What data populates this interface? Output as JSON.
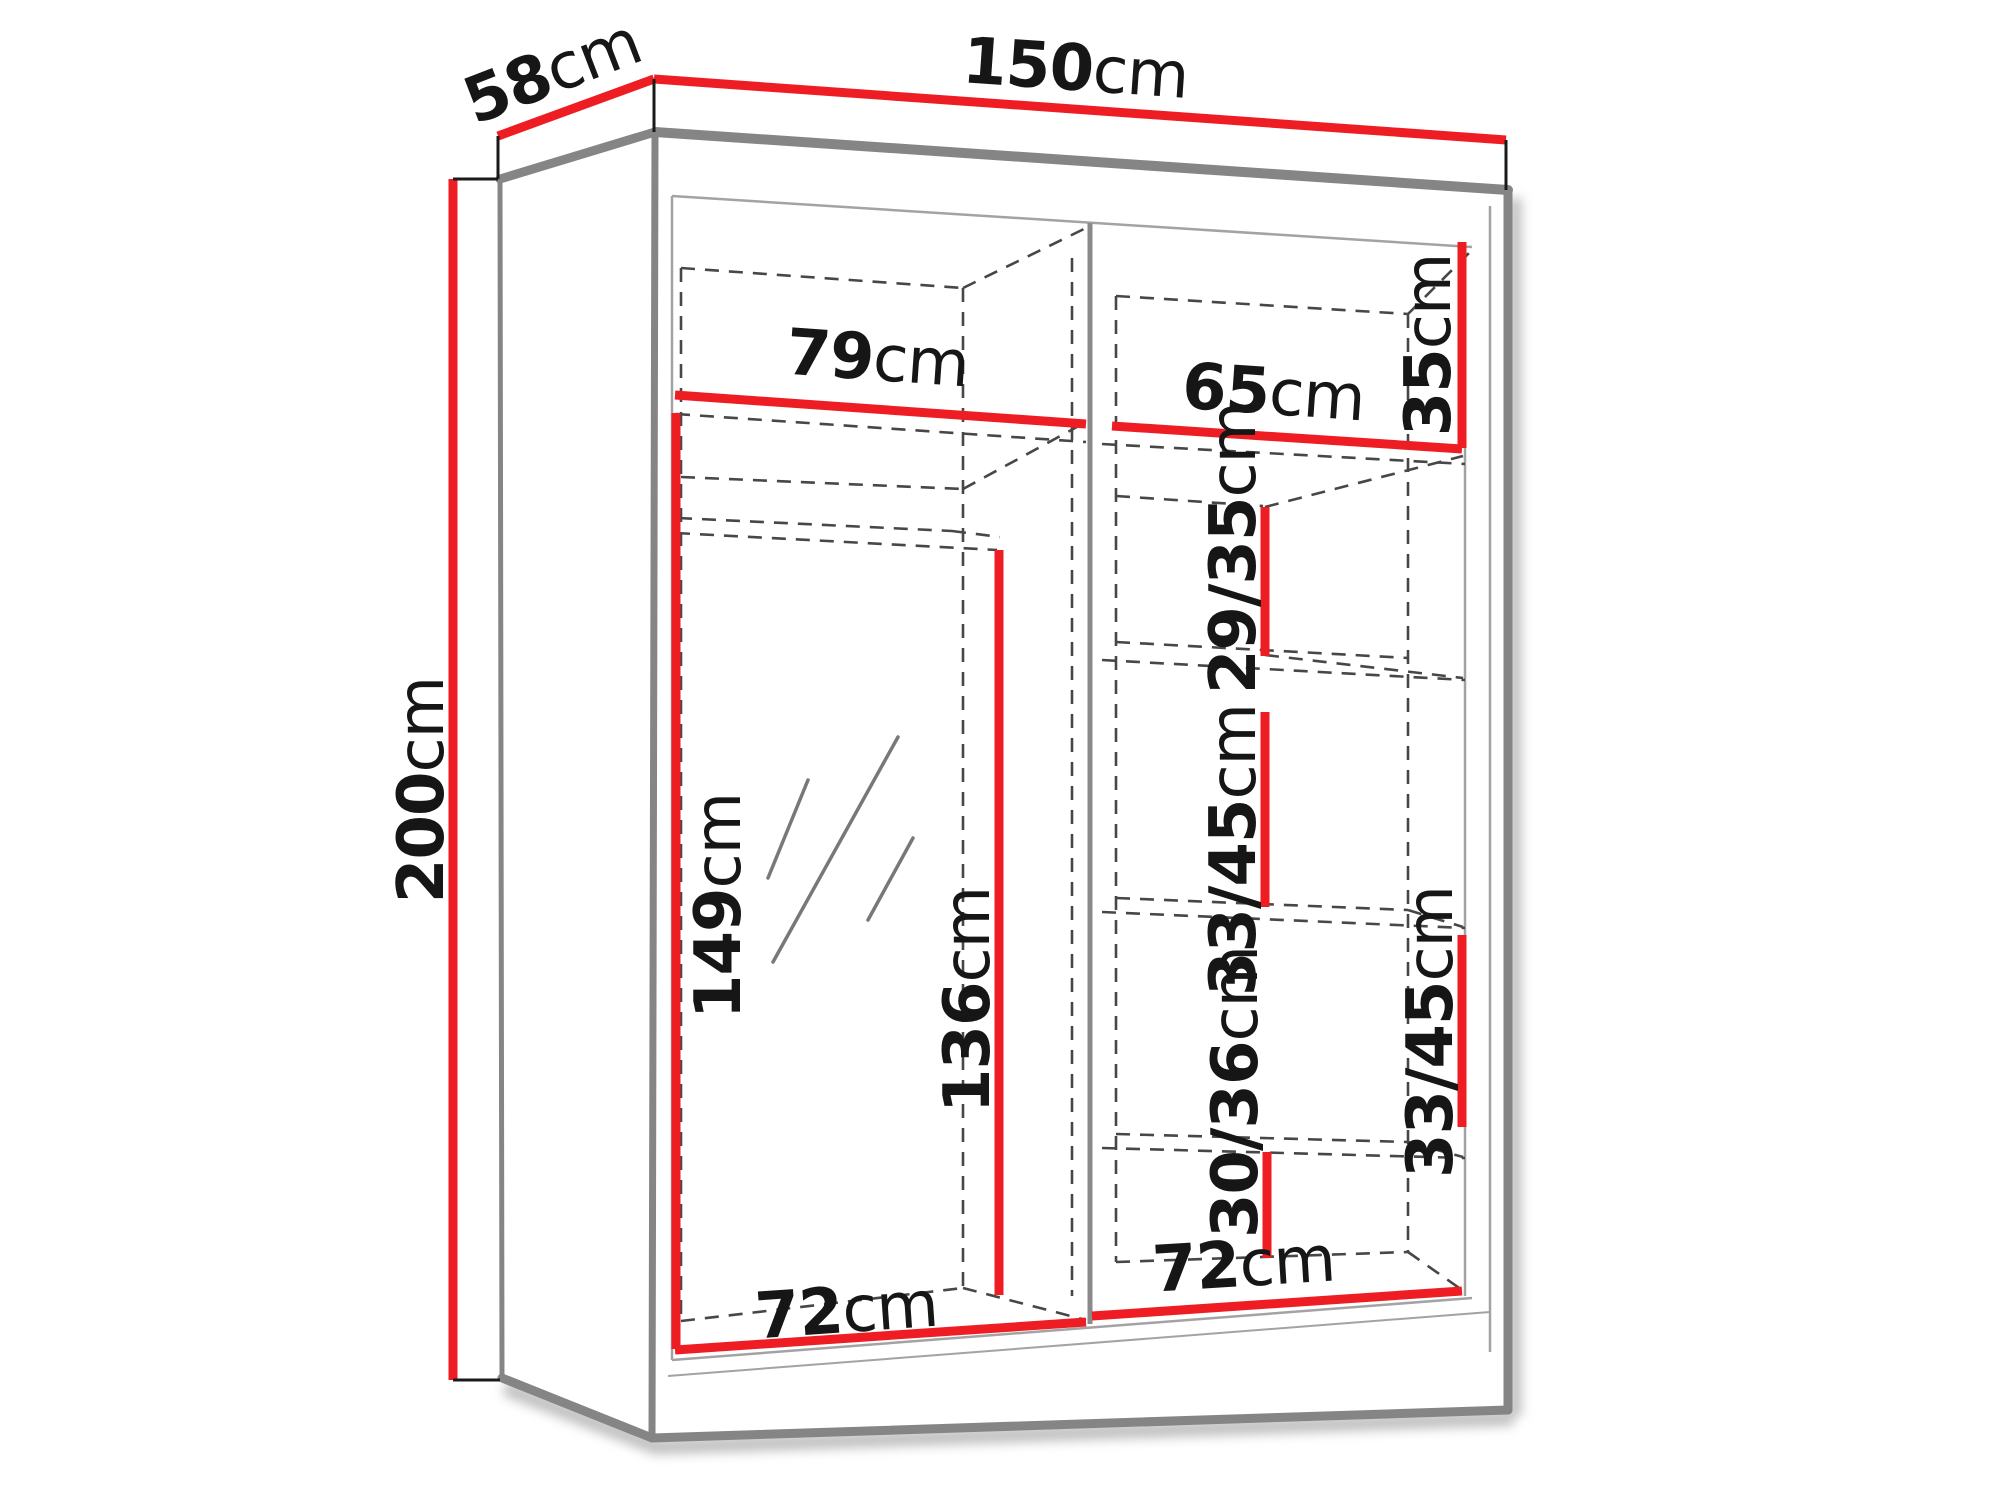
{
  "diagram": {
    "type": "furniture-dimension-diagram",
    "subject": "two-door sliding wardrobe with mirror, exterior and interior dimensions",
    "unit": "cm",
    "colors": {
      "dimension_line_red": "#ee1d23",
      "edge_gray": "#878787",
      "dashed_gray": "#474747",
      "text_black": "#161616",
      "background": "#ffffff"
    },
    "dimensions": {
      "overall": {
        "width": {
          "value": "150",
          "unit": "cm"
        },
        "depth": {
          "value": "58",
          "unit": "cm"
        },
        "height": {
          "value": "200",
          "unit": "cm"
        }
      },
      "top_shelf": {
        "left_width": {
          "value": "79",
          "unit": "cm"
        },
        "right_width": {
          "value": "65",
          "unit": "cm"
        },
        "height": {
          "value": "35",
          "unit": "cm"
        }
      },
      "left_compartment": {
        "front_height": {
          "value": "149",
          "unit": "cm"
        },
        "back_height": {
          "value": "136",
          "unit": "cm"
        },
        "bottom_width": {
          "value": "72",
          "unit": "cm"
        }
      },
      "right_compartment": {
        "upper_gap": {
          "value": "29/35",
          "unit": "cm"
        },
        "middle_gap": {
          "value": "33/45",
          "unit": "cm"
        },
        "lower_gap": {
          "value": "30/36",
          "unit": "cm"
        },
        "right_column_gap": {
          "value": "33/45",
          "unit": "cm"
        },
        "bottom_width": {
          "value": "72",
          "unit": "cm"
        }
      }
    }
  }
}
